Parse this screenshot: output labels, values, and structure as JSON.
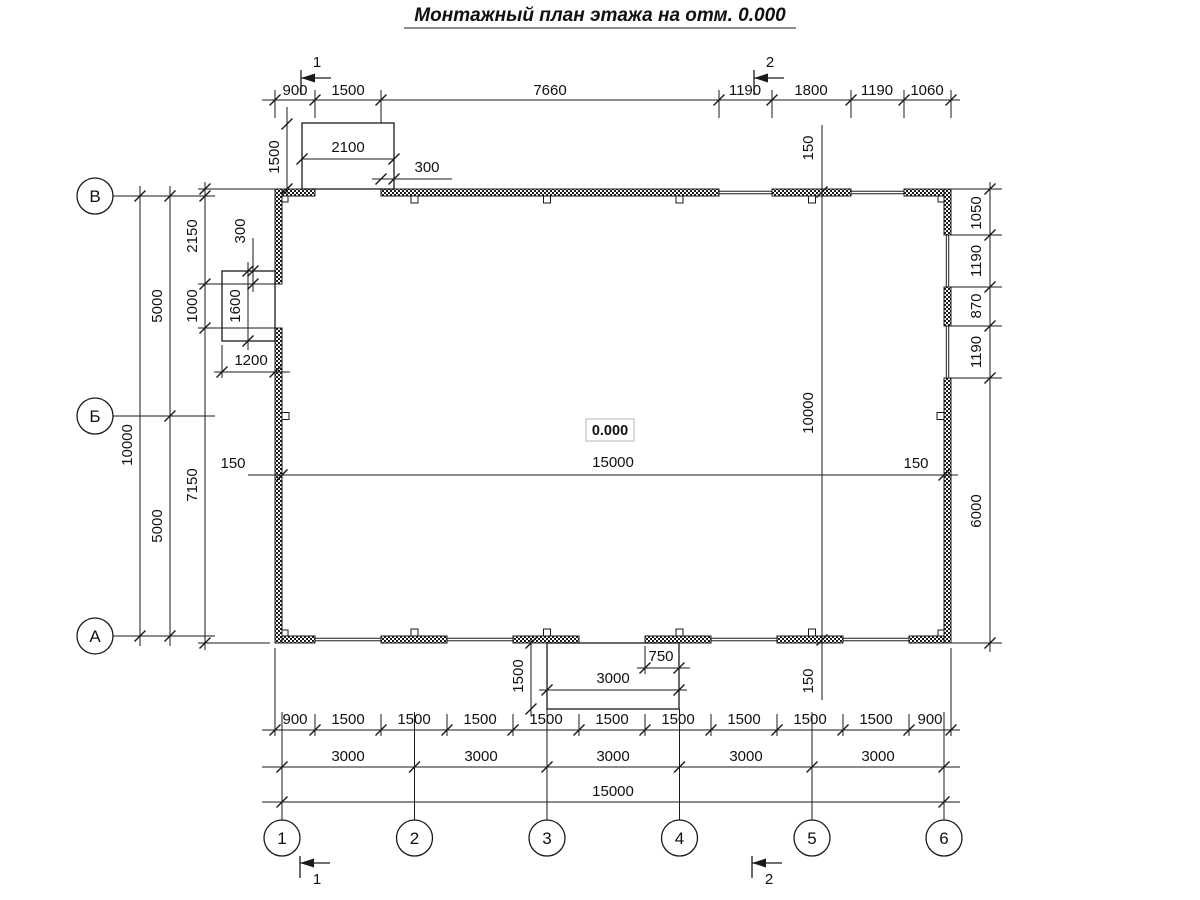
{
  "title": "Монтажный план этажа на отм. 0.000",
  "elevation_marker": "0.000",
  "sections": {
    "s1": "1",
    "s2": "2"
  },
  "grid_axes": {
    "horizontal": [
      "В",
      "Б",
      "А"
    ],
    "vertical": [
      "1",
      "2",
      "3",
      "4",
      "5",
      "6"
    ]
  },
  "dimensions": {
    "top_chain": [
      "900",
      "1500",
      "7660",
      "1190",
      "1800",
      "1190",
      "1060"
    ],
    "top_porch_width": "2100",
    "top_porch_depth": "1500",
    "top_porch_offset": "300",
    "left_chain": [
      "2150",
      "1000",
      "7150"
    ],
    "left_spans": [
      "5000",
      "5000"
    ],
    "left_overall": "10000",
    "left_porch_width": "1200",
    "left_porch_depth": "1600",
    "left_porch_offset": "300",
    "inner_width": "15000",
    "inner_width_wall_left": "150",
    "inner_width_wall_right": "150",
    "inner_height": "10000",
    "inner_height_wall_top": "150",
    "inner_height_wall_bottom": "150",
    "right_chain": [
      "1050",
      "1190",
      "870",
      "1190",
      "6000"
    ],
    "bottom_porch_width": "3000",
    "bottom_porch_depth": "1500",
    "bottom_porch_offset": "750",
    "bottom_chain": [
      "900",
      "1500",
      "1500",
      "1500",
      "1500",
      "1500",
      "1500",
      "1500",
      "1500",
      "1500",
      "900"
    ],
    "bottom_spans": [
      "3000",
      "3000",
      "3000",
      "3000",
      "3000"
    ],
    "bottom_overall": "15000"
  },
  "colors": {
    "line": "#1a1a1a",
    "background": "#ffffff"
  }
}
